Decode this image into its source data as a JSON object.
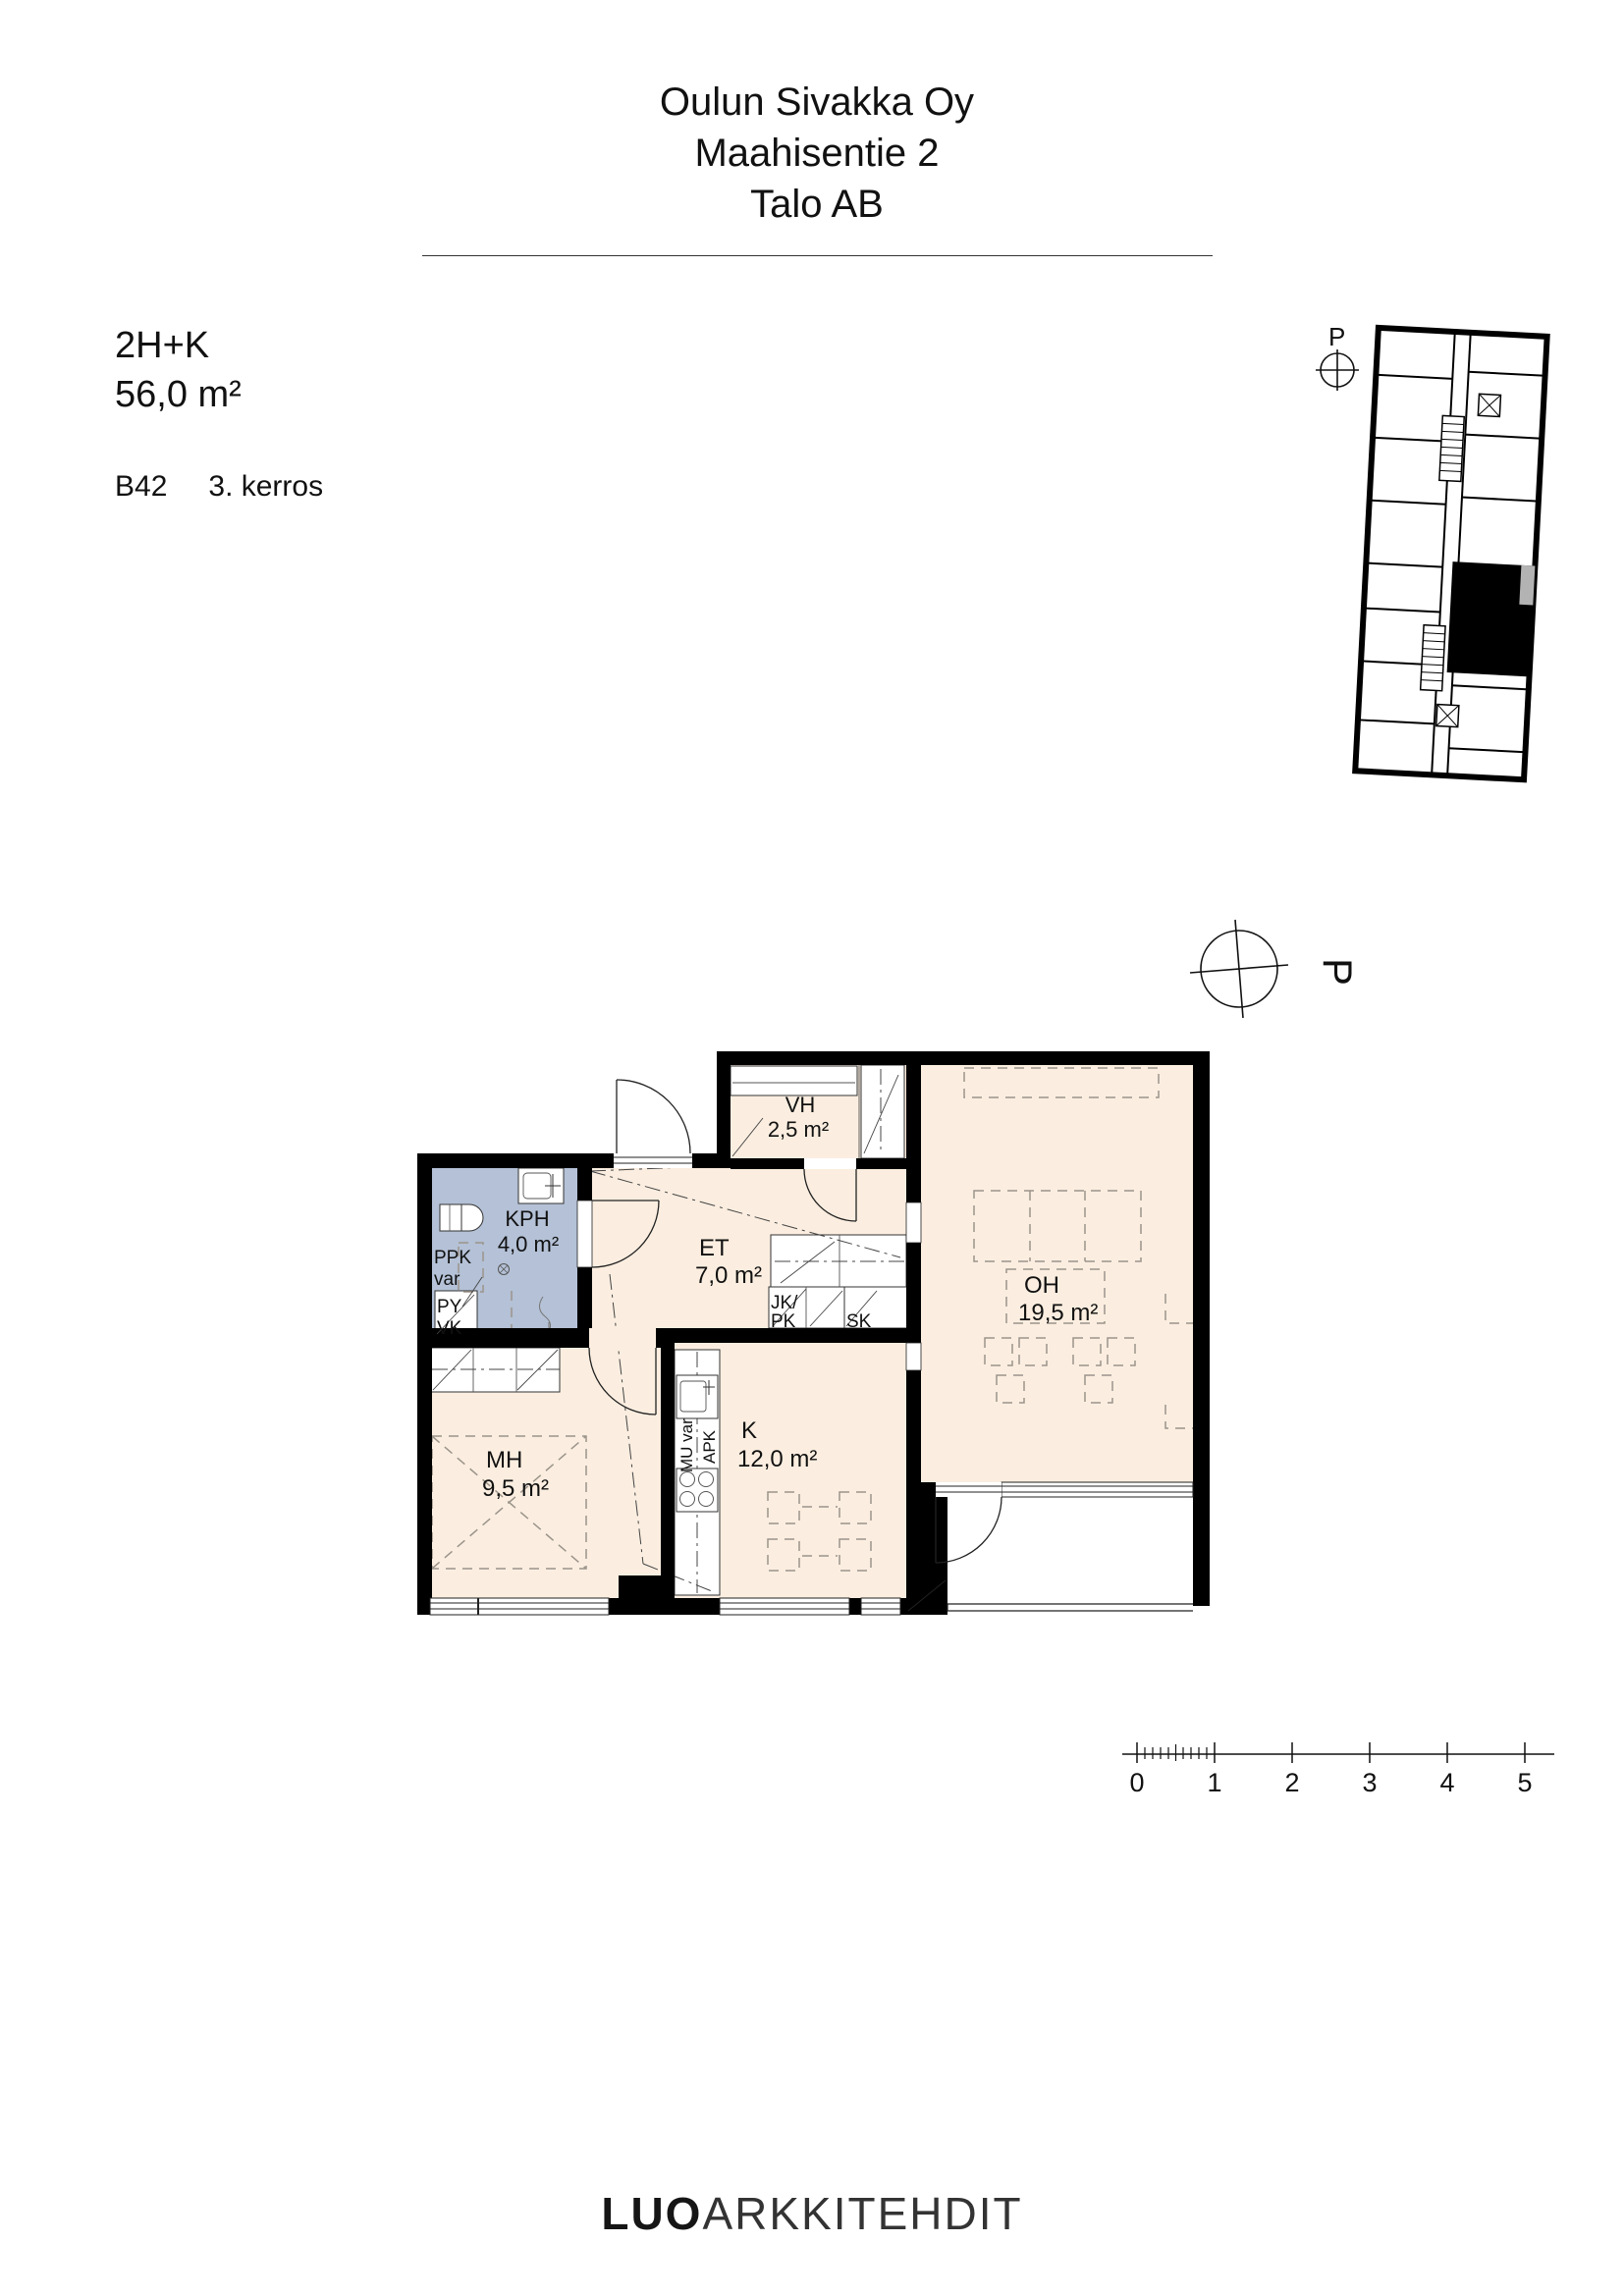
{
  "header": {
    "line1": "Oulun Sivakka Oy",
    "line2": "Maahisentie 2",
    "line3": "Talo AB"
  },
  "info": {
    "type": "2H+K",
    "area": "56,0 m²",
    "unit": "B42",
    "floor": "3. kerros"
  },
  "north": {
    "label": "P"
  },
  "key_plan": {
    "north_label": "P"
  },
  "plan": {
    "rooms": {
      "vh": {
        "name": "VH",
        "area": "2,5 m²"
      },
      "kph": {
        "name": "KPH",
        "area": "4,0 m²"
      },
      "et": {
        "name": "ET",
        "area": "7,0 m²"
      },
      "oh": {
        "name": "OH",
        "area": "19,5 m²"
      },
      "mh": {
        "name": "MH",
        "area": "9,5 m²"
      },
      "k": {
        "name": "K",
        "area": "12,0 m²"
      }
    },
    "labels": {
      "ppk": "PPK",
      "ppk_var": "var",
      "py": "PY",
      "vk": "VK",
      "jk": "JK/",
      "pk": "PK",
      "sk": "SK",
      "mu_var": "MU var",
      "apk": "APK"
    }
  },
  "scale": {
    "ticks": [
      "0",
      "1",
      "2",
      "3",
      "4",
      "5"
    ]
  },
  "footer": {
    "bold": "LUO",
    "light": "ARKKITEHDIT"
  },
  "colors": {
    "floor": "#fbeee0",
    "wet_room": "#b4c1d6",
    "wall": "#000000",
    "dash": "#9b948a"
  }
}
